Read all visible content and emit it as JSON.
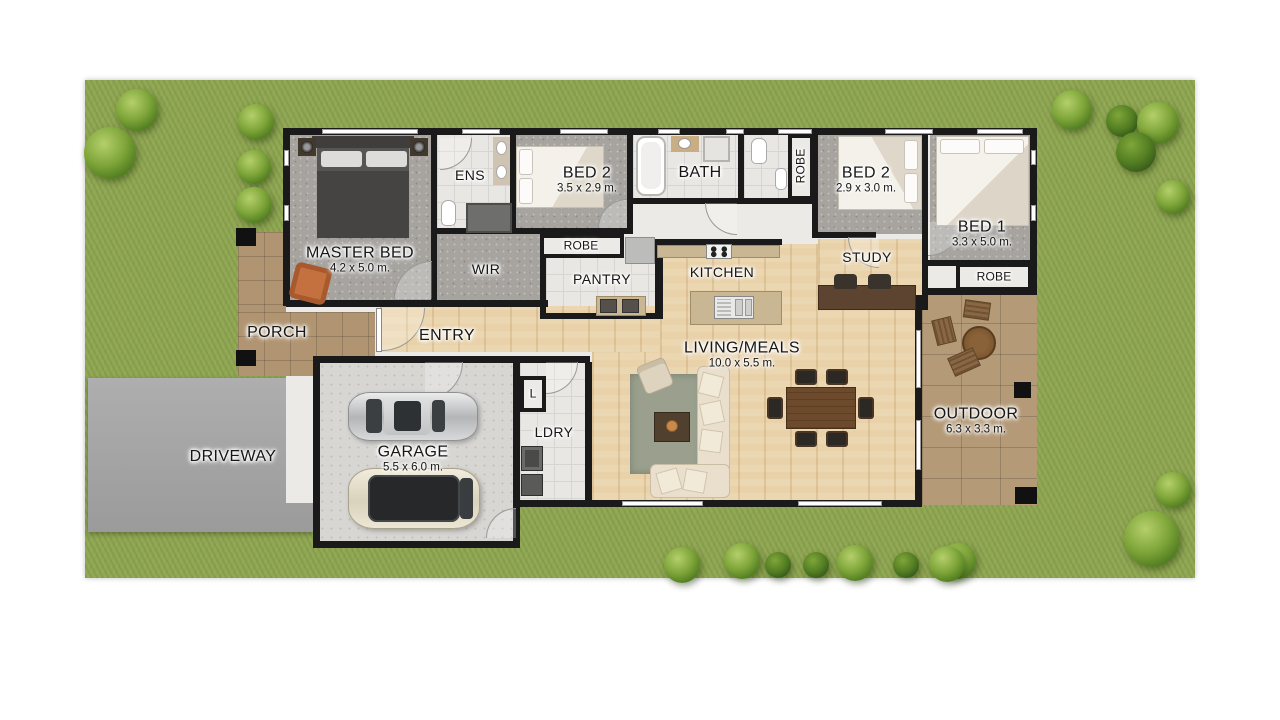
{
  "rooms": {
    "master": {
      "name": "MASTER BED",
      "dims": "4.2 x 5.0 m."
    },
    "ens": {
      "name": "ENS"
    },
    "bed2a": {
      "name": "BED 2",
      "dims": "3.5 x 2.9 m."
    },
    "bath": {
      "name": "BATH"
    },
    "robe_vert": {
      "name": "ROBE"
    },
    "bed2b": {
      "name": "BED 2",
      "dims": "2.9 x 3.0 m."
    },
    "bed1": {
      "name": "BED 1",
      "dims": "3.3 x 5.0 m."
    },
    "robe_top": {
      "name": "ROBE"
    },
    "wir": {
      "name": "WIR"
    },
    "pantry": {
      "name": "PANTRY"
    },
    "kitchen": {
      "name": "KITCHEN"
    },
    "study": {
      "name": "STUDY"
    },
    "robe_bed1": {
      "name": "ROBE"
    },
    "porch": {
      "name": "PORCH"
    },
    "entry": {
      "name": "ENTRY"
    },
    "living": {
      "name": "LIVING/MEALS",
      "dims": "10.0 x 5.5 m."
    },
    "outdoor": {
      "name": "OUTDOOR",
      "dims": "6.3 x 3.3 m."
    },
    "driveway": {
      "name": "DRIVEWAY"
    },
    "garage": {
      "name": "GARAGE",
      "dims": "5.5 x 6.0 m."
    },
    "ldry": {
      "name": "LDRY"
    },
    "linen": {
      "name": "L"
    }
  },
  "colors": {
    "grass": "#90a654",
    "wall": "#1a1a1a",
    "carpet": "#a7a4a0",
    "tile": "#e9e7e3",
    "wood_floor": "#e9d2a9",
    "paving": "#b49a77",
    "concrete": "#d7d6d3",
    "driveway": "#a5a5a5",
    "armchair_accent": "#c4713f",
    "rug": "#9aa08d",
    "sofa": "#e9dfcc",
    "dining_table": "#6d4a2b"
  }
}
